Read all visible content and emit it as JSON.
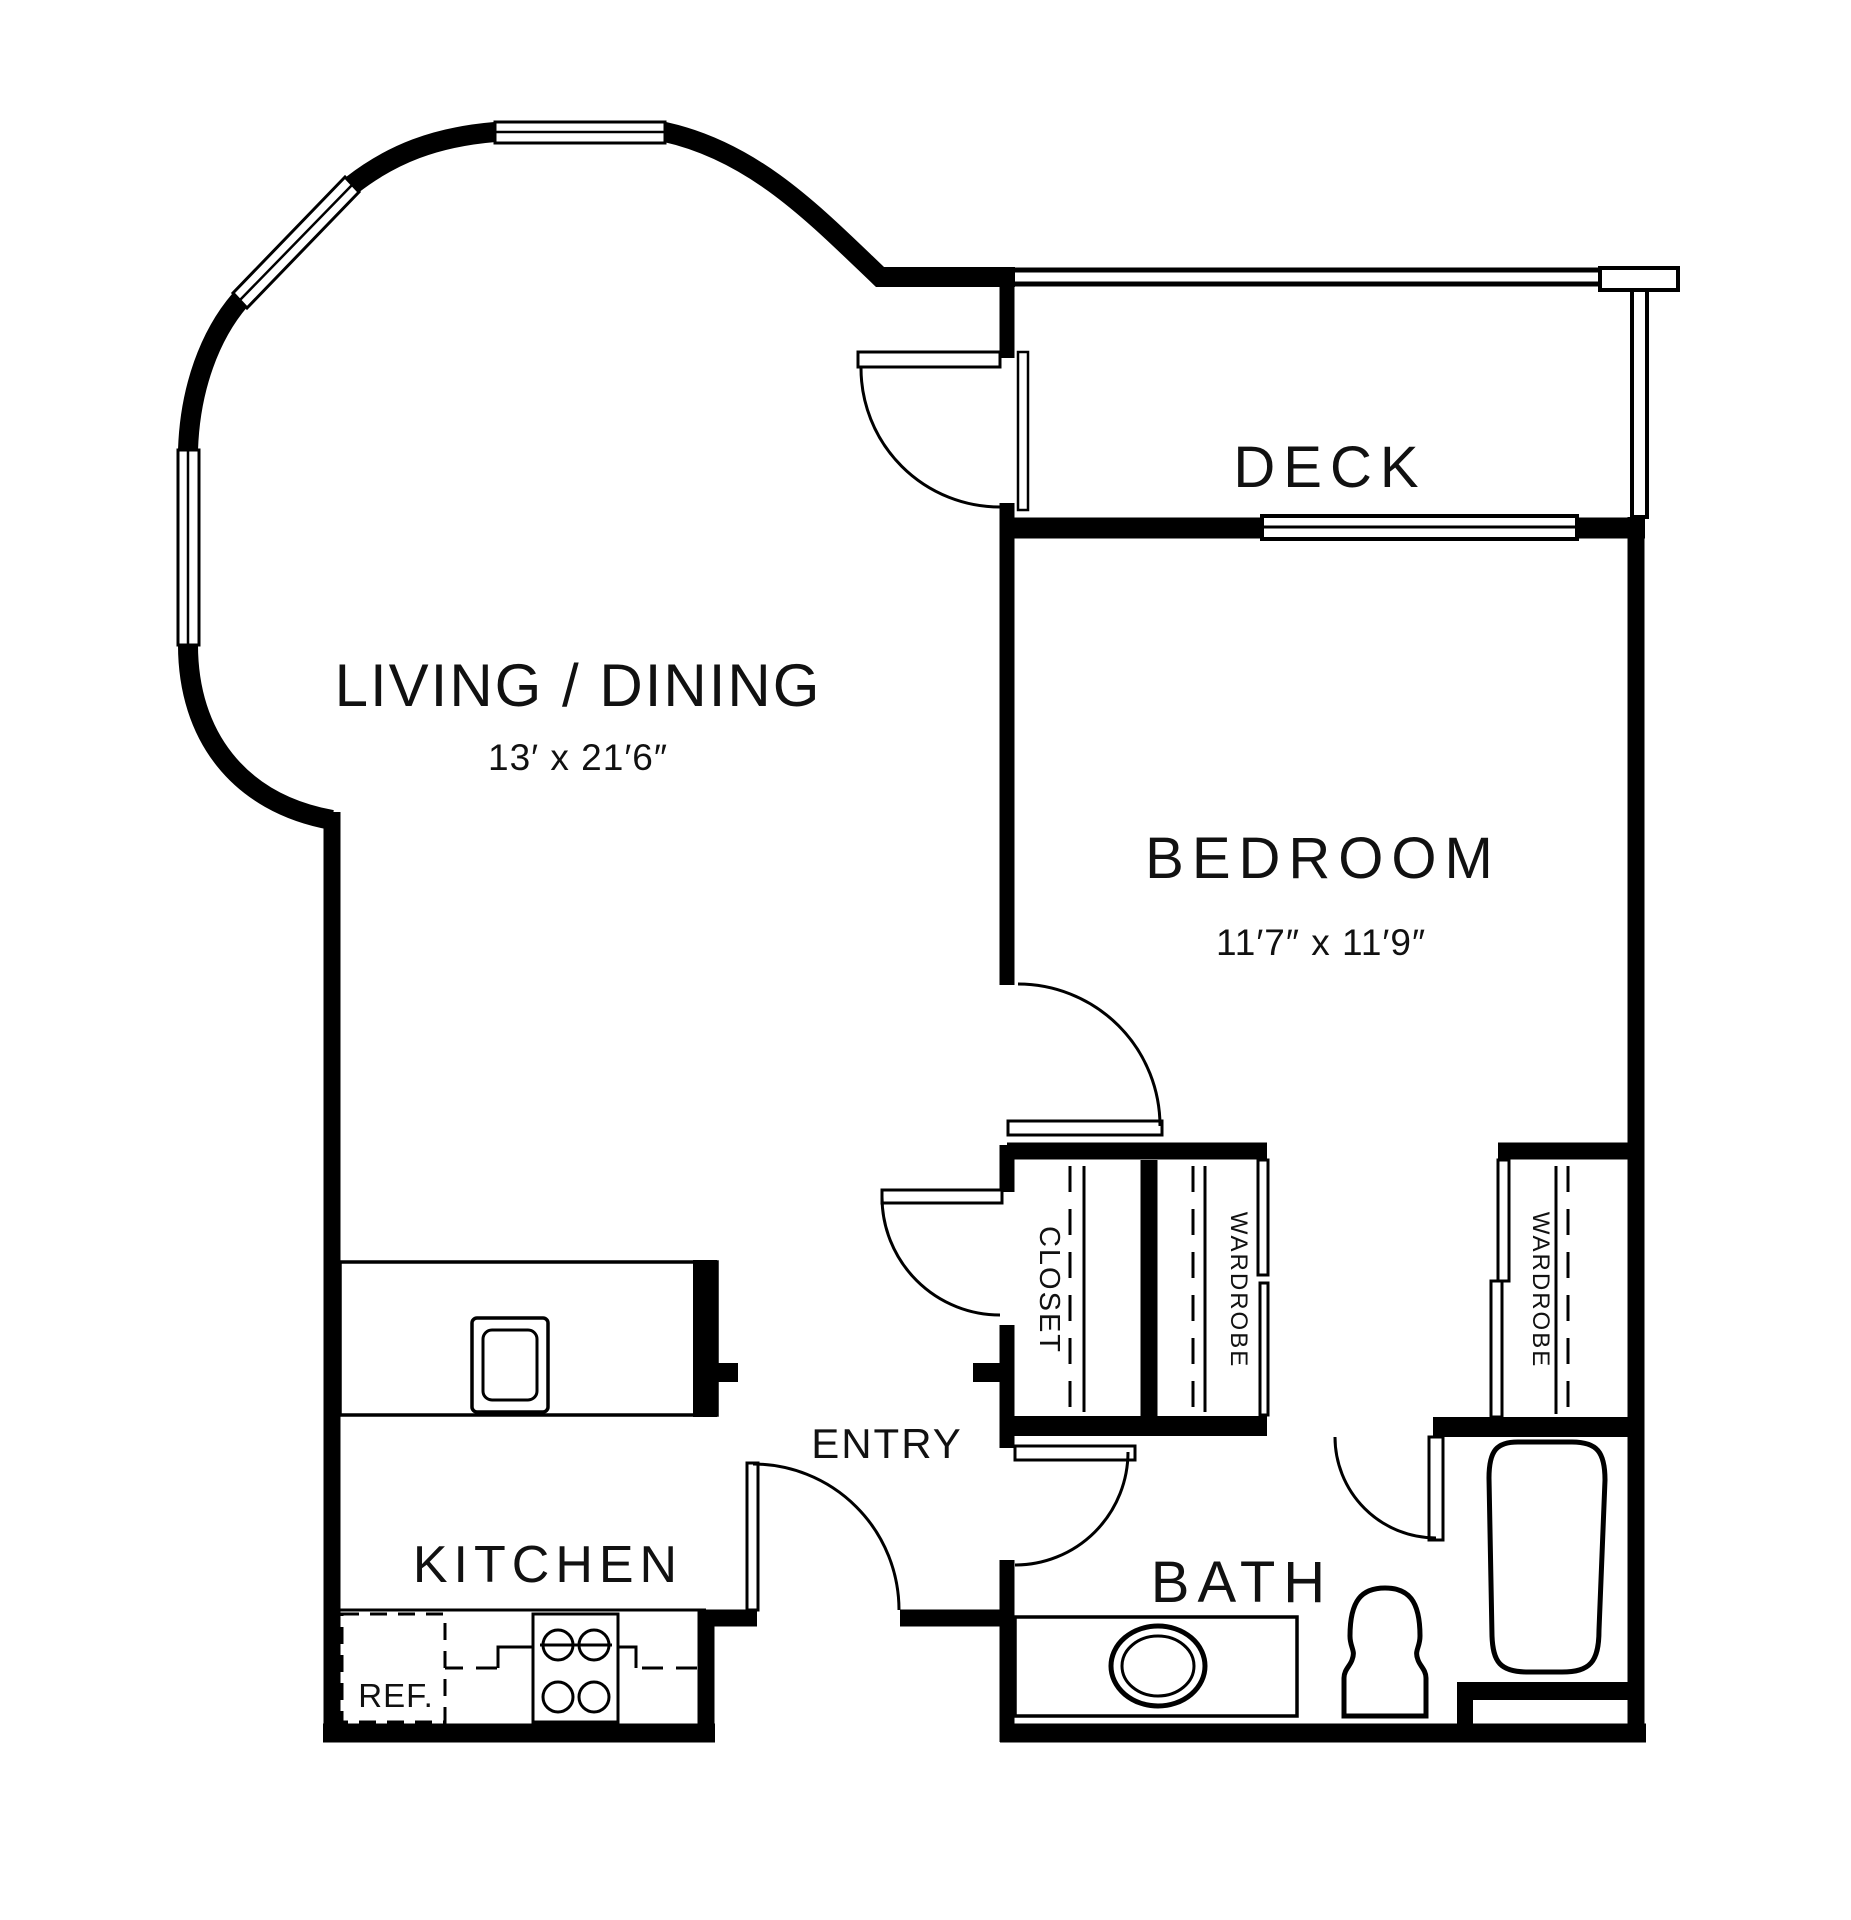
{
  "floorplan": {
    "rooms": {
      "living_dining": {
        "label": "LIVING / DINING",
        "dimensions": "13′ x 21′6″"
      },
      "bedroom": {
        "label": "BEDROOM",
        "dimensions": "11′7″ x 11′9″"
      },
      "deck": {
        "label": "DECK"
      },
      "kitchen": {
        "label": "KITCHEN"
      },
      "entry": {
        "label": "ENTRY"
      },
      "bath": {
        "label": "BATH"
      }
    },
    "storage": {
      "entry_closet": {
        "label": "CLOSET"
      },
      "wardrobe_middle": {
        "label": "WARDROBE"
      },
      "wardrobe_right": {
        "label": "WARDROBE"
      }
    },
    "appliances": {
      "refrigerator": {
        "label": "REF."
      }
    },
    "colors": {
      "wall": "#000000",
      "background": "#ffffff"
    }
  }
}
